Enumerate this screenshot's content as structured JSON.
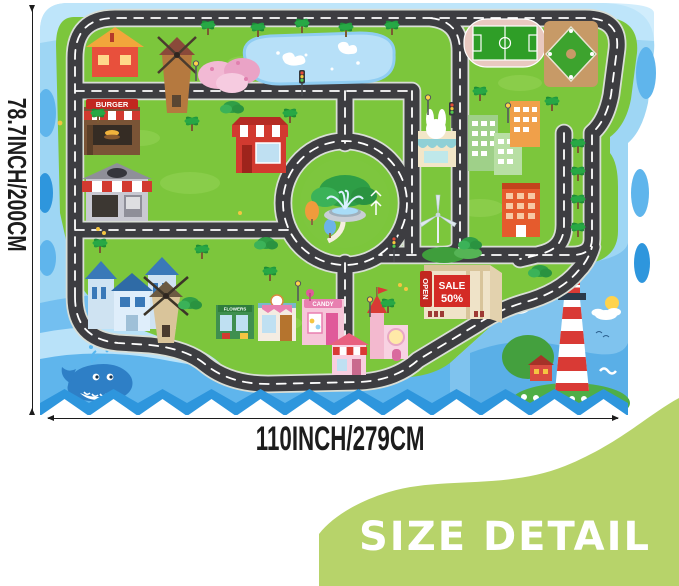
{
  "badge": {
    "label": "SIZE DETAIL",
    "color": "#b7d36a",
    "text_color": "#ffffff"
  },
  "size_labels": {
    "height": "78.7INCH/200CM",
    "width": "110INCH/279CM"
  },
  "mat_signs": {
    "burger": "BURGER",
    "candy": "CANDY",
    "sale_top": "SALE",
    "sale_bottom": "50%",
    "open": "OPEN",
    "flowers": "FLOWERS"
  },
  "colors": {
    "water": "#9ed6f4",
    "water_band_light": "#c6e8fb",
    "water_band_mid": "#5fb5ec",
    "water_band_dark": "#2e96dd",
    "grass": "#7cc63c",
    "road": "#3d3d41",
    "road_dash": "#ffffff",
    "badge_green": "#b7d36a",
    "label_black": "#1c1c1c",
    "sale_sign_red": "#d42b25",
    "candy_pink": "#f6c6d9",
    "pond_blue": "#b7e0f8"
  },
  "features": [
    "road-network",
    "roundabout-fountain",
    "pond",
    "soccer-field",
    "baseball-field",
    "burger-shop",
    "cafe",
    "red-roof-house",
    "brick-windmill",
    "cherry-blossom-trees",
    "red-shop",
    "blue-houses",
    "tan-windmill",
    "flower-shop",
    "bakery",
    "candy-shop",
    "pink-castle",
    "awning-house",
    "shopping-mall",
    "wind-turbine",
    "city-buildings",
    "bunny-shop",
    "palm-trees",
    "street-lamps",
    "traffic-lights",
    "lighthouse",
    "whale",
    "clouds",
    "sun"
  ]
}
